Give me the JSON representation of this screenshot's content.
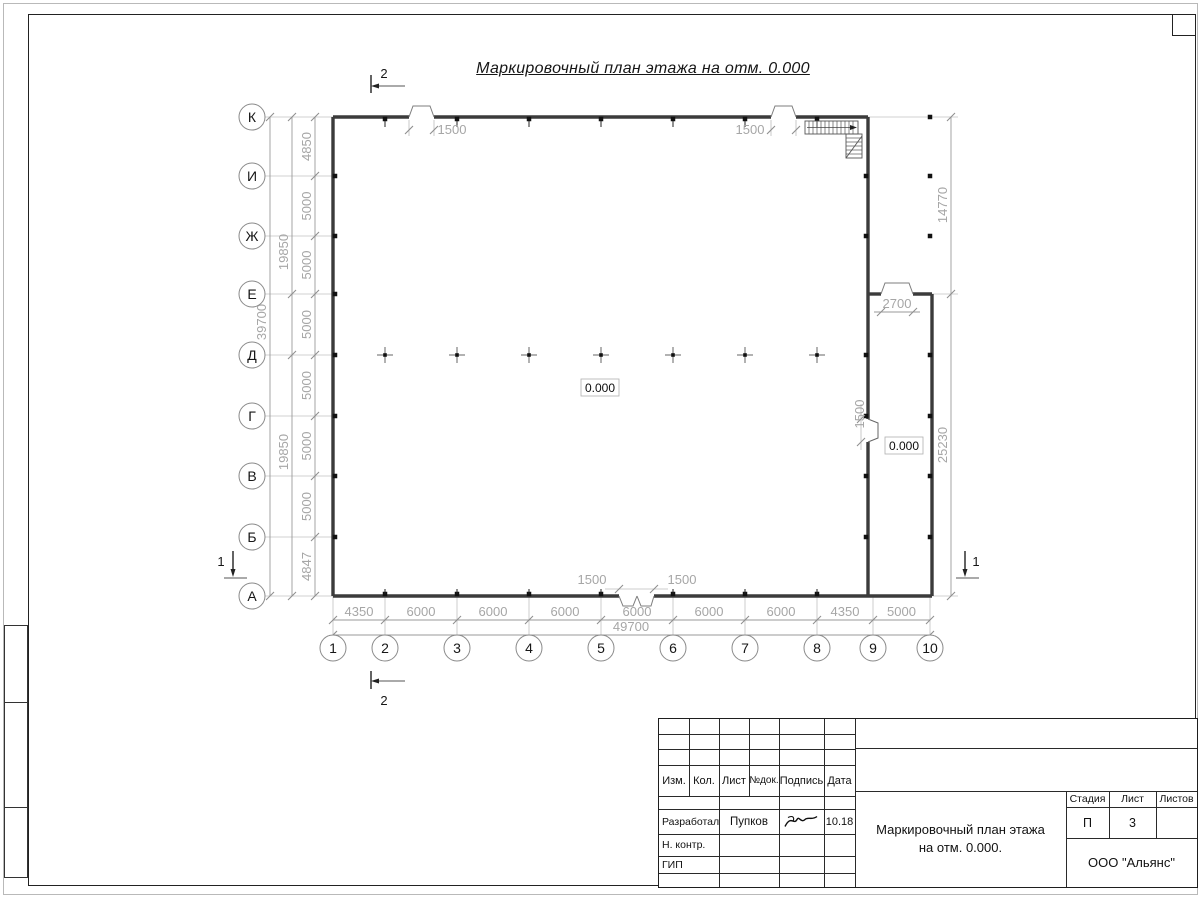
{
  "page": {
    "drawing_title": "Маркировочный план этажа на отм. 0.000"
  },
  "plan": {
    "vertical_axes": [
      "К",
      "И",
      "Ж",
      "Е",
      "Д",
      "Г",
      "В",
      "Б",
      "А"
    ],
    "horizontal_axes": [
      "1",
      "2",
      "3",
      "4",
      "5",
      "6",
      "7",
      "8",
      "9",
      "10"
    ],
    "left_dim_segments": [
      "4850",
      "5000",
      "5000",
      "5000",
      "5000",
      "5000",
      "5000",
      "4847"
    ],
    "left_dim_groups": [
      "19850",
      "19850"
    ],
    "left_dim_total": "39700",
    "bottom_dim_segments": [
      "4350",
      "6000",
      "6000",
      "6000",
      "6000",
      "6000",
      "6000",
      "4350",
      "5000"
    ],
    "bottom_dim_total": "49700",
    "right_dim_upper": "14770",
    "right_dim_lower": "25230",
    "opening_top_left": "1500",
    "opening_top_right": "1500",
    "opening_bottom_left": "1500",
    "opening_bottom_right": "1500",
    "opening_annex_top": "2700",
    "opening_annex_side": "1500",
    "elevation_main": "0.000",
    "elevation_annex": "0.000",
    "section_mark_vertical": "2",
    "section_mark_horizontal": "1"
  },
  "titleblock": {
    "header": [
      "Изм.",
      "Кол.",
      "Лист",
      "№док.",
      "Подпись",
      "Дата"
    ],
    "row_developer_role": "Разработал",
    "row_developer_name": "Пупков",
    "row_developer_date": "10.18",
    "row_ncontrol_role": "Н. контр.",
    "row_gip_role": "ГИП",
    "stage_label": "Стадия",
    "sheet_label": "Лист",
    "sheets_label": "Листов",
    "stage_value": "П",
    "sheet_value": "3",
    "sheets_value": "",
    "doc_title_line1": "Маркировочный план этажа",
    "doc_title_line2": "на отм. 0.000.",
    "company": "ООО \"Альянс\""
  }
}
